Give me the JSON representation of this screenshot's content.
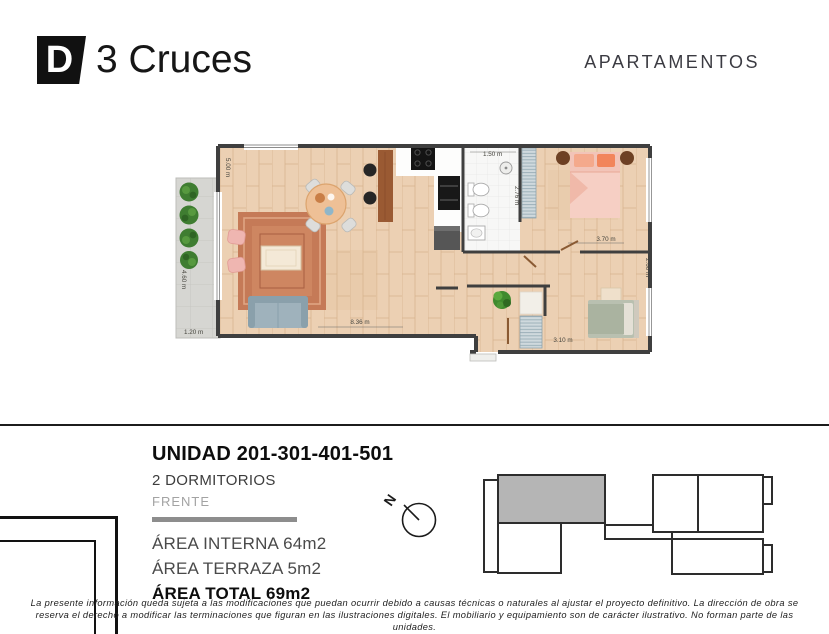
{
  "header": {
    "logo_letter": "D",
    "logo_brand": "3 Cruces",
    "apartments_label": "APARTAMENTOS"
  },
  "unit": {
    "title": "UNIDAD 201-301-401-501",
    "bedrooms": "2 DORMITORIOS",
    "orientation": "FRENTE",
    "area_internal": "ÁREA INTERNA 64m2",
    "area_terrace": "ÁREA TERRAZA 5m2",
    "area_total": "ÁREA TOTAL 69m2"
  },
  "floorplan": {
    "dims": {
      "living_width": "5.00 m",
      "living_length": "8.36 m",
      "terrace_depth": "4.60 m",
      "terrace_width": "1.20 m",
      "bath_width": "1.50 m",
      "bath_depth": "2.76 m",
      "bedroom1_width": "3.70 m",
      "bedroom2_depth": "2.60 m",
      "bedroom2_width": "3.10 m"
    }
  },
  "compass": {
    "north_label": "N"
  },
  "disclaimer": {
    "line1": "La presente información queda sujeta a las modificaciones que puedan ocurrir debido a causas técnicas o naturales al ajustar el proyecto definitivo. La dirección de obra se",
    "line2": "reserva el derecho a modificar las terminaciones que figuran en las ilustraciones digitales. El mobiliario y equipamiento son de carácter ilustrativo. No forman parte de las",
    "line3": "unidades."
  },
  "colors": {
    "accent_dark": "#1c1c1c",
    "divider_gray": "#8d8d8d",
    "highlighted_unit": "#b5b5b5",
    "wood_floor": "#ecd0b3",
    "terrace_floor": "#d6d6d2",
    "wall": "#3f3f3f"
  }
}
